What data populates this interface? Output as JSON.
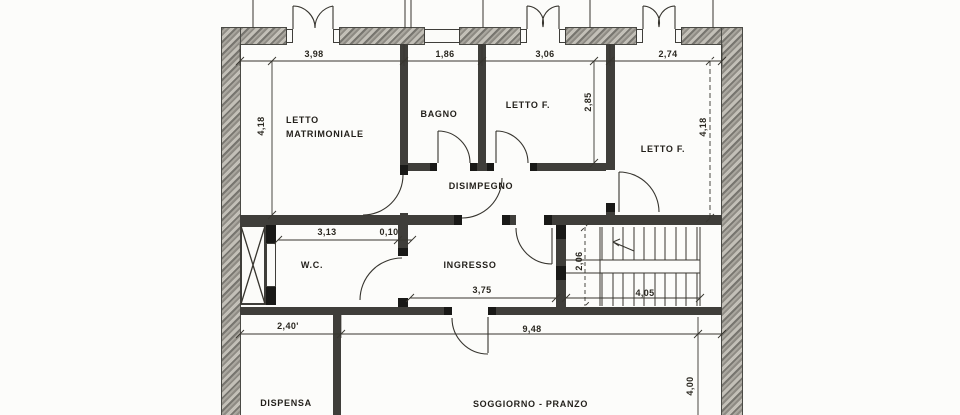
{
  "drawing": {
    "rooms": {
      "letto_matrimoniale": "LETTO\nMATRIMONIALE",
      "bagno": "BAGNO",
      "letto_f_top": "LETTO F.",
      "letto_f_right": "LETTO F.",
      "disimpegno": "DISIMPEGNO",
      "wc": "W.C.",
      "ingresso": "INGRESSO",
      "dispensa": "DISPENSA",
      "soggiorno_pranzo": "SOGGIORNO - PRANZO"
    },
    "dimensions": {
      "top_letto_matrimoniale": "3,98",
      "top_bagno": "1,86",
      "top_letto_f": "3,06",
      "top_letto_f_right": "2,74",
      "left_height": "4,18",
      "letto_f_height": "2,85",
      "right_height": "4,18",
      "wc_width": "3,13",
      "wall_thickness": "0,10",
      "ingresso_width": "3,75",
      "stairs_depth": "2,06",
      "stairs_width": "4,05",
      "dispensa_width": "2,40'",
      "soggiorno_width": "9,48",
      "soggiorno_height": "4,00"
    },
    "colors": {
      "paper": "#fcfcfa",
      "ink": "#37352f",
      "outer_wall": "#8e8b84",
      "inner_wall": "#3f3e3a"
    }
  }
}
